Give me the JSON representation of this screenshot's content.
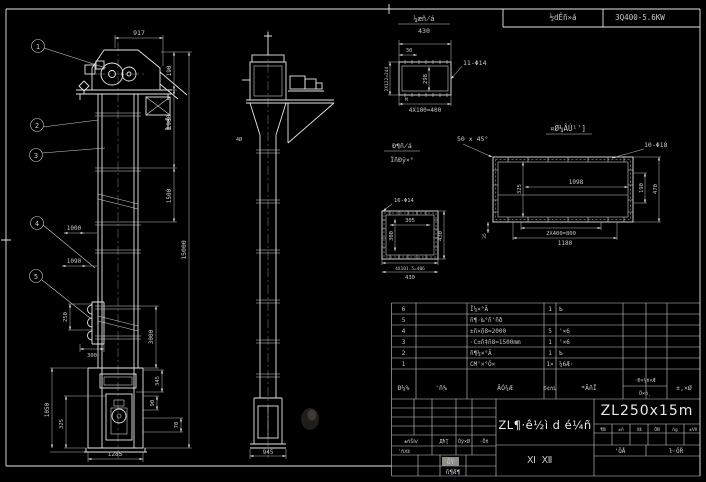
{
  "colors": {
    "bg": "#000000",
    "line": "#e6e6e6",
    "dim_text": "#c9c9c9",
    "model_text": "#a6a69e",
    "stamp_bg": "#8f8f88"
  },
  "top_bar": {
    "cell1": "½dÊñ»á",
    "cell2": "3Q400-5.6KW"
  },
  "front_view": {
    "balloons": [
      "1",
      "2",
      "3",
      "4",
      "5"
    ],
    "dims": {
      "top_width": "917",
      "head_h": "190",
      "upper_h": "1980",
      "mid_h": "1500",
      "total_h": "15000",
      "w1000": "1000",
      "w1090": "1090",
      "bucket_h": "250",
      "bucket_w": "300",
      "lower_h": "3000",
      "boot_h": "1050",
      "door_h": "325",
      "base_w": "1285",
      "spout_h": "345",
      "d90": "90",
      "d70": "70"
    }
  },
  "side_view": {
    "dims": {
      "base_w": "945"
    },
    "note": "4Ø"
  },
  "detail_flange_top": {
    "label": "¼æñ̸á",
    "label_dim": "430",
    "callout": "11-Φ14",
    "mark": "M",
    "dims": {
      "inset": "30",
      "left": "2X122=244",
      "mid": "298",
      "bottom": "4X100=400"
    }
  },
  "detail_frame": {
    "title": "¤Ø¼ÃÚ¹']",
    "chamfer": "50 x 45°",
    "callout": "10-Φ18",
    "dims": {
      "inner_w": "1098",
      "left_h": "325",
      "right_inner": "190",
      "right_outer": "470",
      "bolt_pitch": "2X400=800",
      "overall_w": "1180",
      "edge": "35"
    }
  },
  "detail_flange_small": {
    "label1": "Đ¶ñ̸á",
    "label2": "ÏñĐÿ×°",
    "callout": "16-Φ14",
    "dims": {
      "inner_w": "305",
      "inner_h": "300",
      "right_h": "430",
      "bolt_pitch": "4X101.5=406",
      "overall_w": "430"
    }
  },
  "bom": {
    "headers": {
      "seq": "Đ¼%",
      "dwg": "'ñ%",
      "name": "ÃÓ¾Æ",
      "qty": "Đ¢ñL",
      "material": "*ÃñĨ",
      "weight_top": "·Đ×¼ñ×Æ",
      "weight_bottom": "Ö×ñ¸",
      "remark": "±,×Ø"
    },
    "rows": [
      {
        "seq": "6",
        "name": "Ĭ¼×°Ã",
        "qty": "1",
        "material": "Ƅ׶"
      },
      {
        "seq": "5",
        "name": "ñ¶·‰°ñ'ñð",
        "qty": "",
        "material": ""
      },
      {
        "seq": "4",
        "name": "±ñ×ׇñ8=2000",
        "qty": "5",
        "material": "'×6׶"
      },
      {
        "seq": "3",
        "name": "·C±ñ‡ñ8=1500mm",
        "qty": "1",
        "material": "'×6׶"
      },
      {
        "seq": "2",
        "name": "ñ¶¼×°Ã",
        "qty": "1",
        "material": "Ƅ׶"
      },
      {
        "seq": "1",
        "name": "CM'×°Ö×",
        "qty": "1×",
        "material": "¼6Æ·"
      }
    ]
  },
  "title_block": {
    "main_title": "ZL¶·ê½ì d é¼ñ",
    "model": "ZL250x15m",
    "sheet_label": "Ⅺ  Ⅻ",
    "sig_header": [
      "±ñŠⅣ",
      "ДħŢ",
      "Óÿ×Ø",
      "·Öñ"
    ],
    "sig_row2": "'ñⅫ",
    "stamp": "ĞŸ",
    "stamp2": "ñ¶Æ¶",
    "cells_row": [
      "¶Ñ",
      "±ñ",
      "Ⅻ",
      "ÖÑ",
      "ñg",
      "±Ⅶ"
    ],
    "sheets": {
      "left": "'ÖÅ",
      "right": "ŀ·ÖŘ"
    }
  }
}
